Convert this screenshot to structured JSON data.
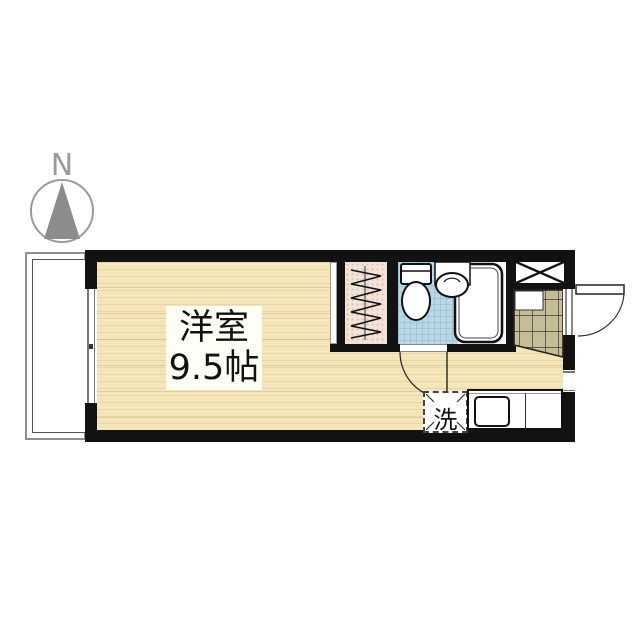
{
  "compass": {
    "north_label": "N"
  },
  "rooms": {
    "main": {
      "name": "洋室",
      "size": "9.5帖"
    },
    "washer": {
      "label": "洗"
    }
  },
  "colors": {
    "wall": "#121212",
    "floor_wood": "#f4e6b9",
    "bathroom_blue": "#b7d8e4",
    "tile_khaki": "#c6bd96",
    "closet_pink": "#f2e4d9",
    "line_gray": "#9a9a9a"
  }
}
